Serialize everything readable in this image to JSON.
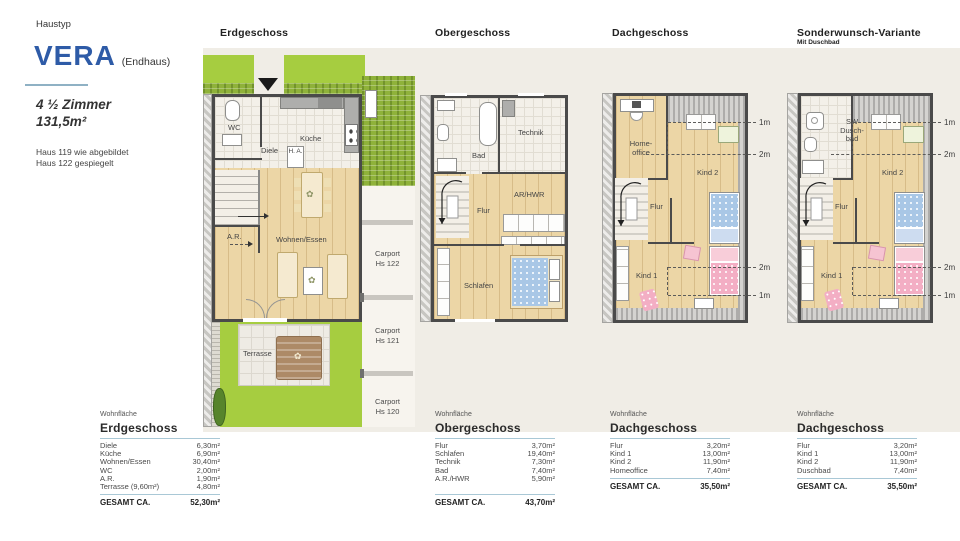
{
  "sidebar": {
    "eyebrow": "Haustyp",
    "title": "VERA",
    "title_suffix": "(Endhaus)",
    "rooms": "4 ½ Zimmer",
    "area": "131,5m²",
    "note1": "Haus 119 wie abgebildet",
    "note2": "Haus 122 gespiegelt",
    "accent_color": "#2e5ba7",
    "rule_color": "#8fb1c4"
  },
  "headers": {
    "eg": "Erdgeschoss",
    "og": "Obergeschoss",
    "dg": "Dachgeschoss",
    "sw": "Sonderwunsch-Variante",
    "sw_sub": "Mit Duschbad"
  },
  "eg": {
    "wc": "WC",
    "kueche": "Küche",
    "diele": "Diele",
    "ha": "H. A.",
    "ar": "A.R.",
    "wohnen": "Wohnen/Essen",
    "terrasse": "Terrasse",
    "carport1a": "Carport",
    "carport1b": "Hs 122",
    "carport2a": "Carport",
    "carport2b": "Hs 121",
    "carport3a": "Carport",
    "carport3b": "Hs 120"
  },
  "og": {
    "bad": "Bad",
    "technik": "Technik",
    "flur": "Flur",
    "arhwr": "AR/HWR",
    "schlafen": "Schlafen"
  },
  "dg": {
    "homeoffice": "Home-office",
    "kind2": "Kind 2",
    "flur": "Flur",
    "kind1": "Kind 1",
    "m1": "1m",
    "m2": "2m",
    "m3": "2m",
    "m4": "1m"
  },
  "sw": {
    "duschbad": "SW Dusch-bad",
    "kind2": "Kind 2",
    "flur": "Flur",
    "kind1": "Kind 1",
    "m1": "1m",
    "m2": "2m",
    "m3": "2m",
    "m4": "1m"
  },
  "tables": [
    {
      "eyebrow": "Wohnfläche",
      "title": "Erdgeschoss",
      "rows": [
        {
          "label": "Diele",
          "value": "6,30m²"
        },
        {
          "label": "Küche",
          "value": "6,90m²"
        },
        {
          "label": "Wohnen/Essen",
          "value": "30,40m²"
        },
        {
          "label": "WC",
          "value": "2,00m²"
        },
        {
          "label": "A.R.",
          "value": "1,90m²"
        },
        {
          "label": "Terrasse (9,60m²)",
          "value": "4,80m²"
        }
      ],
      "total_label": "GESAMT CA.",
      "total_value": "52,30m²"
    },
    {
      "eyebrow": "Wohnfläche",
      "title": "Obergeschoss",
      "rows": [
        {
          "label": "Flur",
          "value": "3,70m²"
        },
        {
          "label": "Schlafen",
          "value": "19,40m²"
        },
        {
          "label": "Technik",
          "value": "7,30m²"
        },
        {
          "label": "Bad",
          "value": "7,40m²"
        },
        {
          "label": "A.R./HWR",
          "value": "5,90m²"
        }
      ],
      "total_label": "GESAMT CA.",
      "total_value": "43,70m²"
    },
    {
      "eyebrow": "Wohnfläche",
      "title": "Dachgeschoss",
      "rows": [
        {
          "label": "Flur",
          "value": "3,20m²"
        },
        {
          "label": "Kind 1",
          "value": "13,00m²"
        },
        {
          "label": "Kind 2",
          "value": "11,90m²"
        },
        {
          "label": "Homeoffice",
          "value": "7,40m²"
        }
      ],
      "total_label": "GESAMT CA.",
      "total_value": "35,50m²"
    },
    {
      "eyebrow": "Wohnfläche",
      "title": "Dachgeschoss",
      "rows": [
        {
          "label": "Flur",
          "value": "3,20m²"
        },
        {
          "label": "Kind 1",
          "value": "13,00m²"
        },
        {
          "label": "Kind 2",
          "value": "11,90m²"
        },
        {
          "label": "Duschbad",
          "value": "7,40m²"
        }
      ],
      "total_label": "GESAMT CA.",
      "total_value": "35,50m²"
    }
  ]
}
